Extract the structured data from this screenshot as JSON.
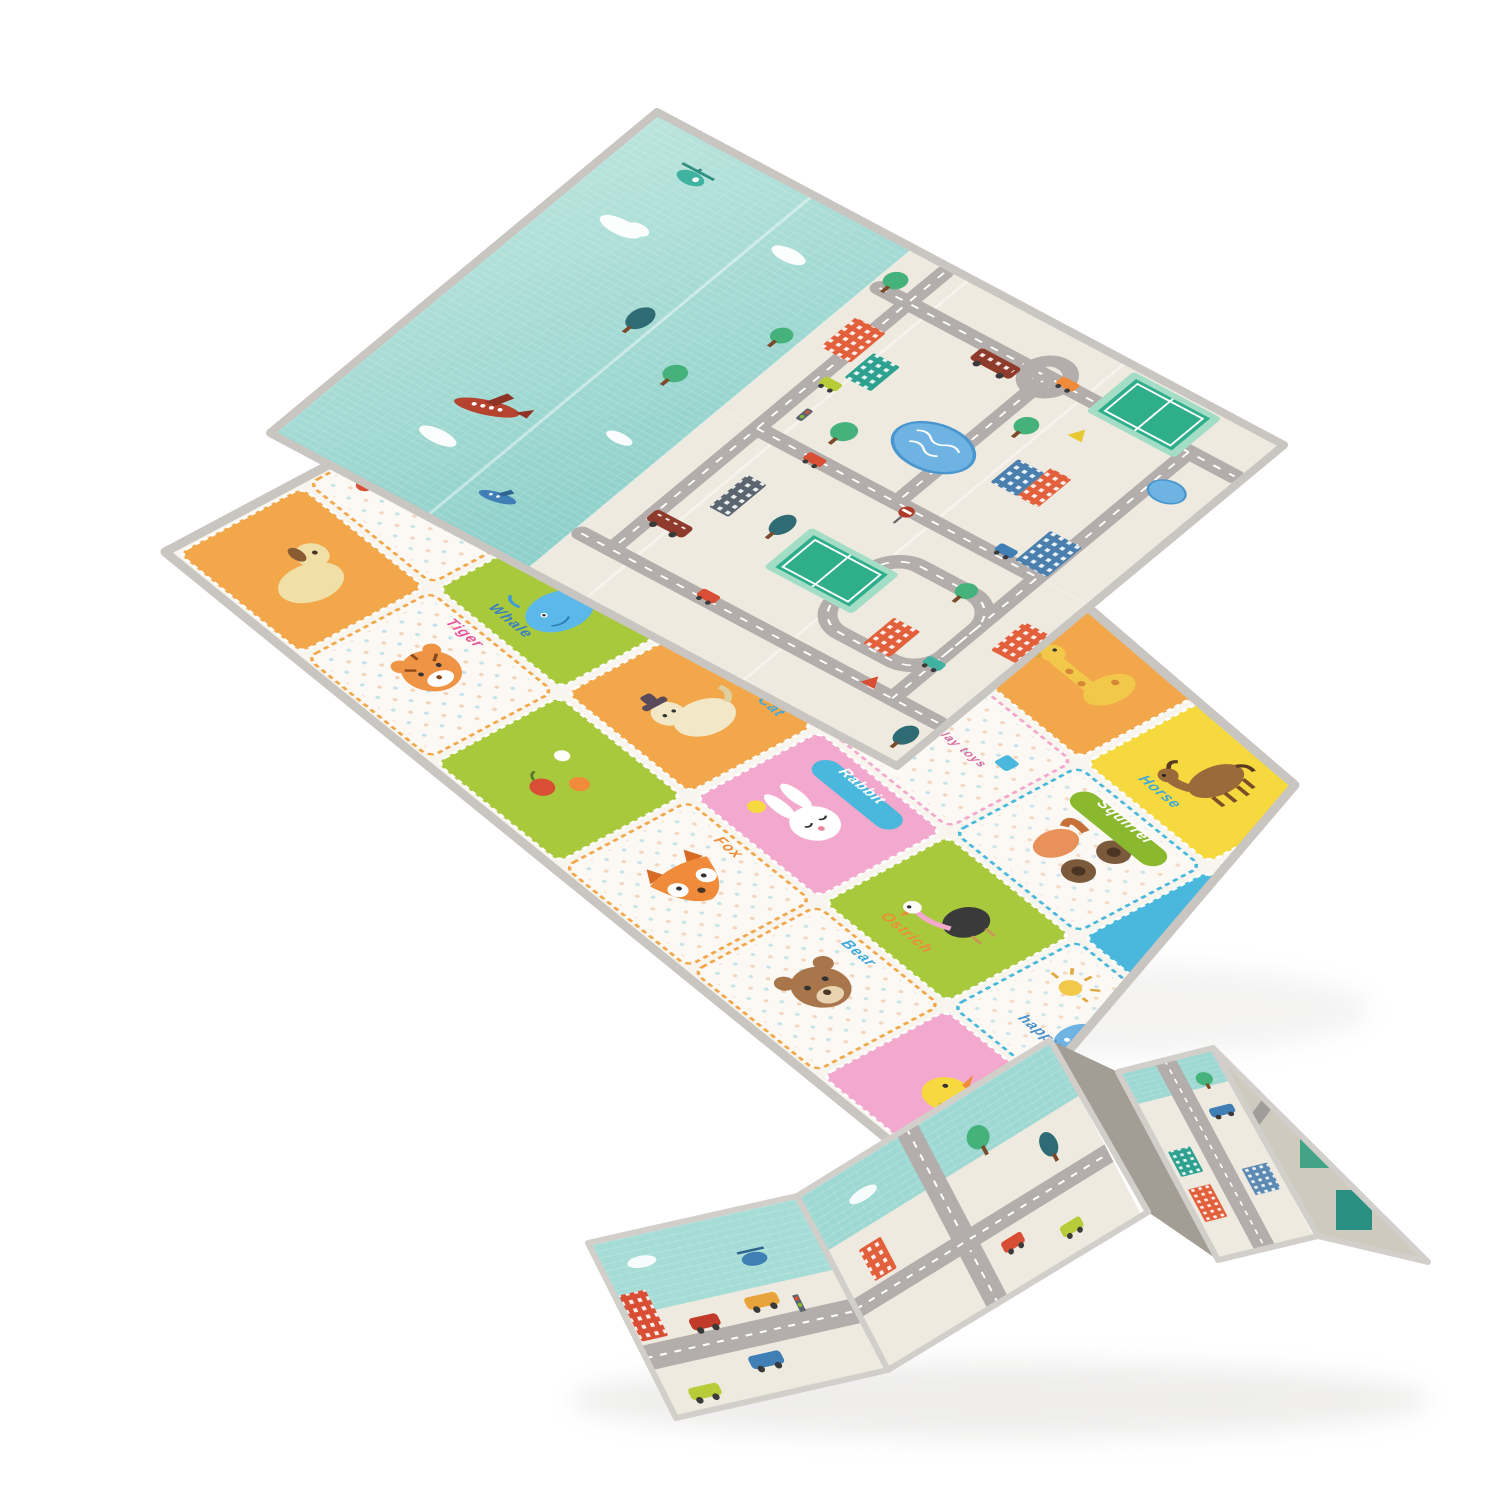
{
  "scene": {
    "background": "#ffffff"
  },
  "road_mat": {
    "sky_color": "#9ed8d2",
    "sky_color_light": "#bce5de",
    "ground_color": "#efeadf",
    "road_color": "#b3aeab",
    "road_line_color": "#ffffff",
    "court_color": "#2fae8c",
    "court_frame_color": "#a3ddc6",
    "pond_color": "#6fb3e3",
    "pond_edge_color": "#4a97cf",
    "trim_color": "#c9c5c1",
    "building_orange": "#e2603c",
    "building_blue": "#4b80ae",
    "building_teal": "#2fa190",
    "building_brown": "#8f3b2c",
    "building_slate": "#5a6570",
    "car_lime": "#b8cc3a",
    "car_red": "#d94f35",
    "car_blue": "#3f7fb5",
    "car_teal": "#3fb3a0",
    "car_orange": "#ef8b3a",
    "tree_green": "#45b27b",
    "tree_dark": "#2f6b74",
    "tree_trunk": "#7a4a2a",
    "plane_red": "#b5432e",
    "cloud_color": "#ffffff"
  },
  "animal_mat": {
    "base_color": "#f8f5ef",
    "trim_color": "#c9c5c1",
    "tile_orange": "#f2a84a",
    "tile_green": "#a9c93c",
    "tile_blue": "#49b8dc",
    "tile_yellow": "#f6d93e",
    "tile_pink": "#f3a8cd",
    "tile_white": "#fcf9f4",
    "dot_orange": "#e9a06a",
    "dot_blue": "#7ac4de",
    "tiles": [
      {
        "label": "",
        "bg": "#f2a84a",
        "label_color": "#e8559b",
        "icon": "dog"
      },
      {
        "label": "HELLO MY FRIEND",
        "bg": "#fcf9f4",
        "label_color": "#7ab648",
        "icon": "text"
      },
      {
        "label": "Goldfish",
        "bg": "#49b8dc",
        "label_color": "#f3a8cd",
        "icon": "goldfish"
      },
      {
        "label": "Chick",
        "bg": "#fcf9f4",
        "label_color": "#2fa9c0",
        "icon": "squirrel-chick"
      },
      {
        "label": "Tiger",
        "bg": "#fcf9f4",
        "label_color": "#e8559b",
        "icon": "tiger"
      },
      {
        "label": "Whale",
        "bg": "#a9c93c",
        "label_color": "#3a7fc2",
        "icon": "whale"
      },
      {
        "label": "Fish",
        "bg": "#fcf9f4",
        "label_color": "#2fa9c0",
        "icon": "fish"
      },
      {
        "label": "Owl",
        "bg": "#a9c93c",
        "label_color": "#ef8b3a",
        "icon": "owl"
      },
      {
        "label": "",
        "bg": "#a9c93c",
        "label_color": "#e8559b",
        "icon": "fruit"
      },
      {
        "label": "Cat",
        "bg": "#f2a84a",
        "label_color": "#3fa9dc",
        "icon": "cat"
      },
      {
        "label": "Hedgehog",
        "bg": "#fcf9f4",
        "label_color": "#7ab648",
        "icon": "hedgehog"
      },
      {
        "label": "Sheep",
        "bg": "#f6d93e",
        "label_color": "#2fa9c0",
        "icon": "sheep"
      },
      {
        "label": "Fox",
        "bg": "#fcf9f4",
        "label_color": "#ef8b3a",
        "icon": "fox"
      },
      {
        "label": "Rabbit",
        "bg": "#f3a8cd",
        "label_color": "#ffffff",
        "icon": "rabbit"
      },
      {
        "label": "Let's play toys",
        "bg": "#fcf9f4",
        "label_color": "#d86a9e",
        "icon": "toys"
      },
      {
        "label": "",
        "bg": "#f2a84a",
        "label_color": "#e8559b",
        "icon": "giraffe"
      },
      {
        "label": "Bear",
        "bg": "#fcf9f4",
        "label_color": "#3fa9dc",
        "icon": "bear"
      },
      {
        "label": "Ostrich",
        "bg": "#a9c93c",
        "label_color": "#ef8b3a",
        "icon": "ostrich"
      },
      {
        "label": "Squirrel",
        "bg": "#fcf9f4",
        "label_color": "#ffffff",
        "icon": "cart"
      },
      {
        "label": "Horse",
        "bg": "#f6d93e",
        "label_color": "#3fa9dc",
        "icon": "horse"
      },
      {
        "label": "",
        "bg": "#f3a8cd",
        "label_color": "#e8559b",
        "icon": "duck"
      },
      {
        "label": "happy day",
        "bg": "#fcf9f4",
        "label_color": "#4a90c8",
        "icon": "elephant-sun"
      },
      {
        "label": "",
        "bg": "#49b8dc",
        "label_color": "#ffffff",
        "icon": "bird"
      },
      {
        "label": "",
        "bg": "#f3a8cd",
        "label_color": "#ffffff",
        "icon": "heart"
      }
    ]
  },
  "folded_mat": {
    "sky_color": "#9ed8d2",
    "ground_color": "#efeadf",
    "road_color": "#b3aeab",
    "trim_color": "#d2cfcb",
    "shadow_face_color": "#a39d96"
  }
}
